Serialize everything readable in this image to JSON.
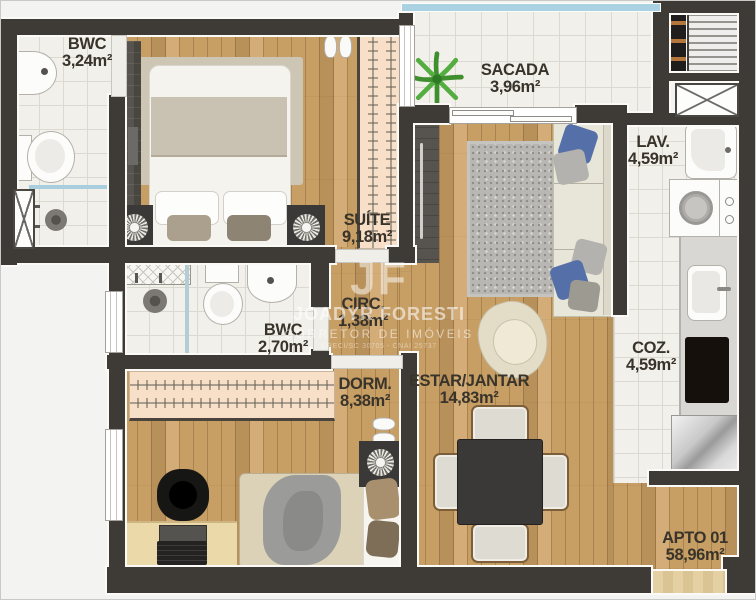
{
  "rooms": {
    "bwc1": {
      "label": "BWC",
      "area": "3,24m²"
    },
    "suite": {
      "label": "SUÍTE",
      "area": "9,18m²"
    },
    "sacada": {
      "label": "SACADA",
      "area": "3,96m²"
    },
    "lav": {
      "label": "LAV.",
      "area": "4,59m²"
    },
    "circ": {
      "label": "CIRC.",
      "area": "1,38m²"
    },
    "bwc2": {
      "label": "BWC",
      "area": "2,70m²"
    },
    "dorm": {
      "label": "DORM.",
      "area": "8,38m²"
    },
    "estar": {
      "label": "ESTAR/JANTAR",
      "area": "14,83m²"
    },
    "coz": {
      "label": "COZ.",
      "area": "4,59m²"
    },
    "apto": {
      "label": "APTO 01",
      "area": "58,96m²"
    }
  },
  "watermark": {
    "logo": "JF",
    "name": "JOADYR FORESTI",
    "role": "CORRETOR DE IMÓVEIS",
    "credentials": "CRECI/SC 30705 - CNAI 25737"
  },
  "colors": {
    "wall": "#3e3b37",
    "wood": "#c79e63",
    "wood_dark": "#b8905a",
    "wood_light": "#d3ac77",
    "tile": "#f2f0ea",
    "tile_line": "#dcd9d1",
    "glass": "#abd2e2",
    "closet": "#f8dfc7",
    "counter": "#d8d7d3",
    "label": "#39342b"
  }
}
